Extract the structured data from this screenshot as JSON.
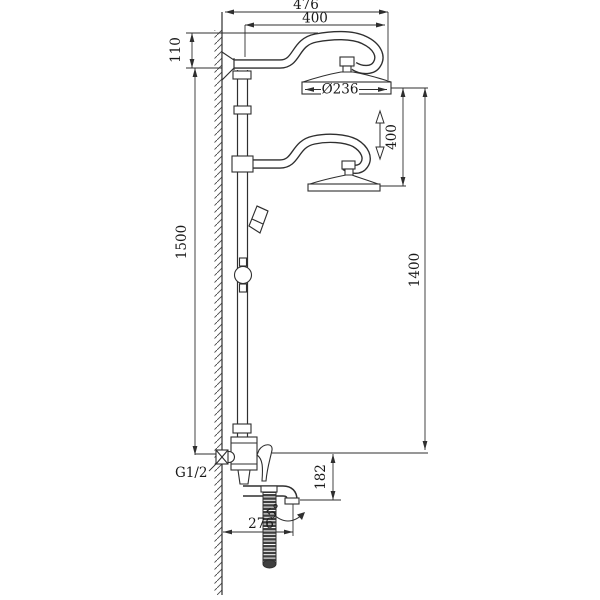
{
  "diagram": {
    "type": "technical-installation-drawing",
    "subject": "wall-mounted dual-head shower column with tub spout and hand-shower hose",
    "colors": {
      "line": "#2f2f2f",
      "background": "#ffffff",
      "hose_fill": "#3f3f3f"
    },
    "dimensions": {
      "overall_reach_top": "476",
      "arm_reach_top": "400",
      "top_offset": "110",
      "head_diameter": "Ø236",
      "head_travel": "400",
      "height_wall_side": "1500",
      "height_right_side": "1400",
      "spout_drop": "182",
      "spout_reach": "276",
      "spout_angle": "5°",
      "inlet_thread": "G1/2"
    }
  }
}
